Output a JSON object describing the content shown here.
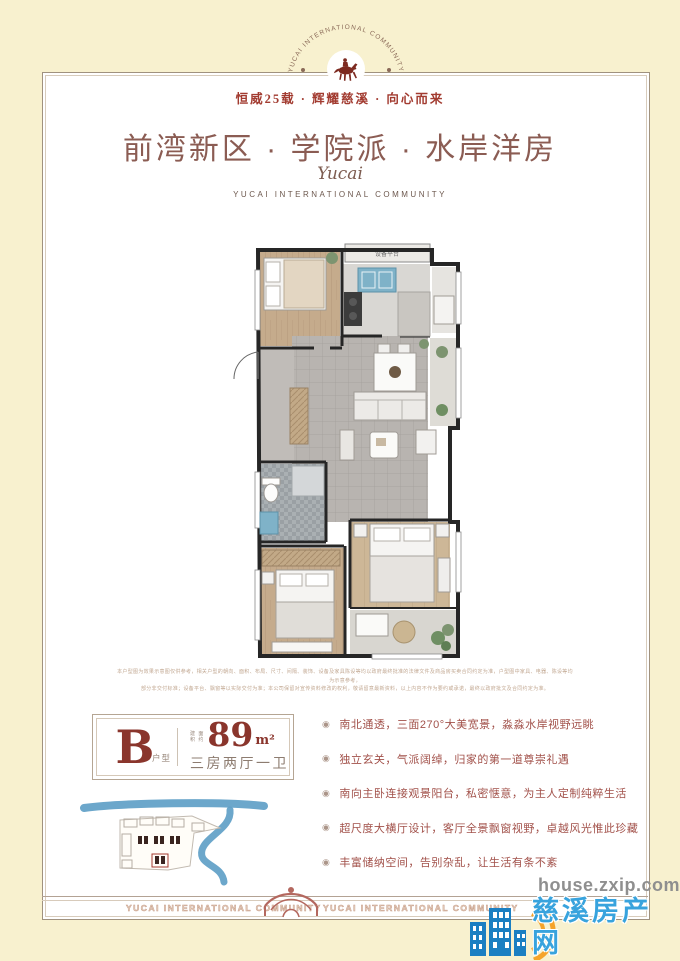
{
  "header": {
    "arc_text": "YUCAI INTERNATIONAL COMMUNITY",
    "slogan": "恒威25载 · 辉耀慈溪 · 向心而来",
    "title": "前湾新区 · 学院派 · 水岸洋房",
    "logo_script": "Yucai",
    "logo_sub": "YUCAI INTERNATIONAL COMMUNITY"
  },
  "floor_plan": {
    "platform_label": "设备平台"
  },
  "disclaimer": {
    "line1": "本户型图为效果示意图仅供参考，相关户型的朝向、面积、布局、尺寸、间隔、装饰、设备及家具陈设等均以政府最终批准的法律文件及商品房买卖合同约定为准，户型图中家具、电器、陈设等均为示意参考，",
    "line2": "部分非交付标准；设备平台、飘窗等以实际交付为准；本公司保留对宣传资料修改的权利，敬请留意最新资料，以上内容不作为要约或承诺，最终以政府批文及合同约定为准。"
  },
  "unit": {
    "letter": "B",
    "letter_suffix": "户型",
    "area_prefix_top": "建 面",
    "area_prefix_bottom": "积 约",
    "area_value": "89",
    "area_unit": "m²",
    "layout": "三房两厅一卫"
  },
  "features": {
    "marker": "◉",
    "items": [
      "南北通透，三面270°大美宽景，淼淼水岸视野远眺",
      "独立玄关，气派阔绰，归家的第一道尊崇礼遇",
      "南向主卧连接观景阳台，私密惬意，为主人定制纯粹生活",
      "超尺度大横厅设计，客厅全景飘窗视野，卓越风光惟此珍藏",
      "丰富储纳空间，告别杂乱，让生活有条不紊"
    ]
  },
  "footer": {
    "band_text_left": "YUCAI INTERNATIONAL COMMUNITY",
    "band_text_right": "YUCAI INTERNATIONAL COMMUNITY"
  },
  "watermark": {
    "site": "house.zxip.com",
    "name": "慈溪房产网"
  },
  "colors": {
    "background": "#f8f1cf",
    "accent_red": "#8a352c",
    "slogan_red": "#a23b30",
    "title_brown": "#8b5c53",
    "feature_red": "#a2514a",
    "river_blue": "#5f9fc7",
    "watermark_blue": "#38a3dd",
    "watermark_orange": "#f5a32a"
  }
}
